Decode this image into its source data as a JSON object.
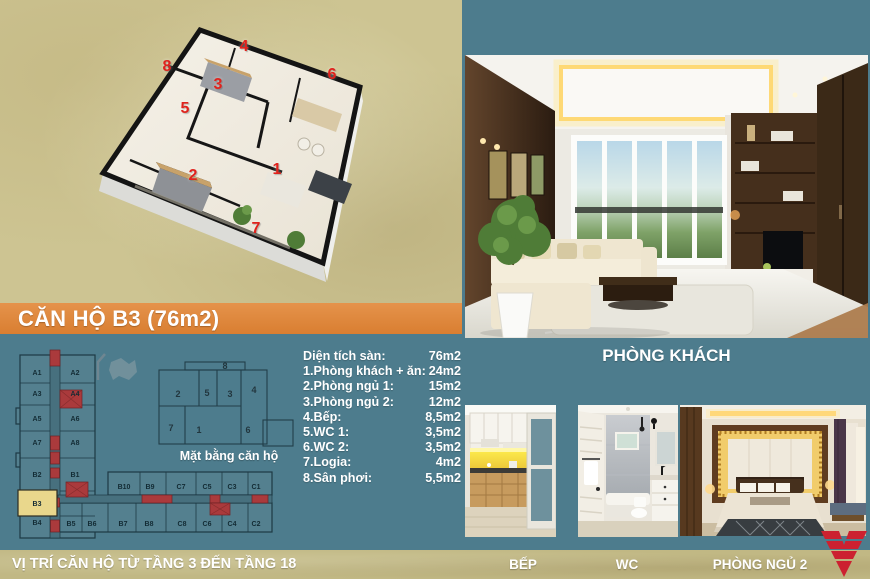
{
  "banner": {
    "title": "CĂN HỘ B3 (76m2)"
  },
  "specs": [
    {
      "label": "Diện tích sàn:",
      "value": "76m2"
    },
    {
      "label": "1.Phòng khách + ăn:",
      "value": "24m2"
    },
    {
      "label": "2.Phòng ngủ 1:",
      "value": "15m2"
    },
    {
      "label": "3.Phòng ngủ 2:",
      "value": "12m2"
    },
    {
      "label": "4.Bếp:",
      "value": "8,5m2"
    },
    {
      "label": "5.WC 1:",
      "value": "3,5m2"
    },
    {
      "label": "6.WC 2:",
      "value": "3,5m2"
    },
    {
      "label": "7.Logia:",
      "value": "4m2"
    },
    {
      "label": "8.Sân phơi:",
      "value": "5,5m2"
    }
  ],
  "plan3d": {
    "room_numbers": [
      "1",
      "2",
      "3",
      "4",
      "5",
      "6",
      "7",
      "8"
    ]
  },
  "plan2d": {
    "caption": "Mặt bằng căn hộ",
    "room_numbers": [
      "1",
      "2",
      "3",
      "4",
      "5",
      "6",
      "7",
      "8"
    ]
  },
  "floor_plate": {
    "highlighted_unit": "B3",
    "tower_units_left": [
      "A1",
      "A3",
      "A5",
      "A7",
      "B2",
      "B3",
      "B4"
    ],
    "tower_units_right": [
      "A2",
      "A4",
      "A6",
      "A8",
      "B1"
    ],
    "wing_top_units": [
      "B10",
      "B9",
      "C7",
      "C5",
      "C3",
      "C1"
    ],
    "wing_bottom_units": [
      "B5",
      "B6",
      "B7",
      "B8",
      "C8",
      "C6",
      "C4",
      "C2"
    ]
  },
  "captions": {
    "living": "PHÒNG KHÁCH",
    "kitchen": "BẾP",
    "wc": "WC",
    "bedroom": "PHÒNG NGỦ 2"
  },
  "footer": {
    "note": "VỊ TRÍ CĂN HỘ TỪ TẦNG 3 ĐẾN TẦNG 18"
  },
  "colors": {
    "teal": "#4d7c8d",
    "beige": "#cdc492",
    "footer_beige": "#c1b884",
    "banner_orange": "#e08a3c",
    "accent_red": "#cc2130",
    "highlight_yellow": "#e9d78c",
    "number_red": "#e0231d"
  }
}
